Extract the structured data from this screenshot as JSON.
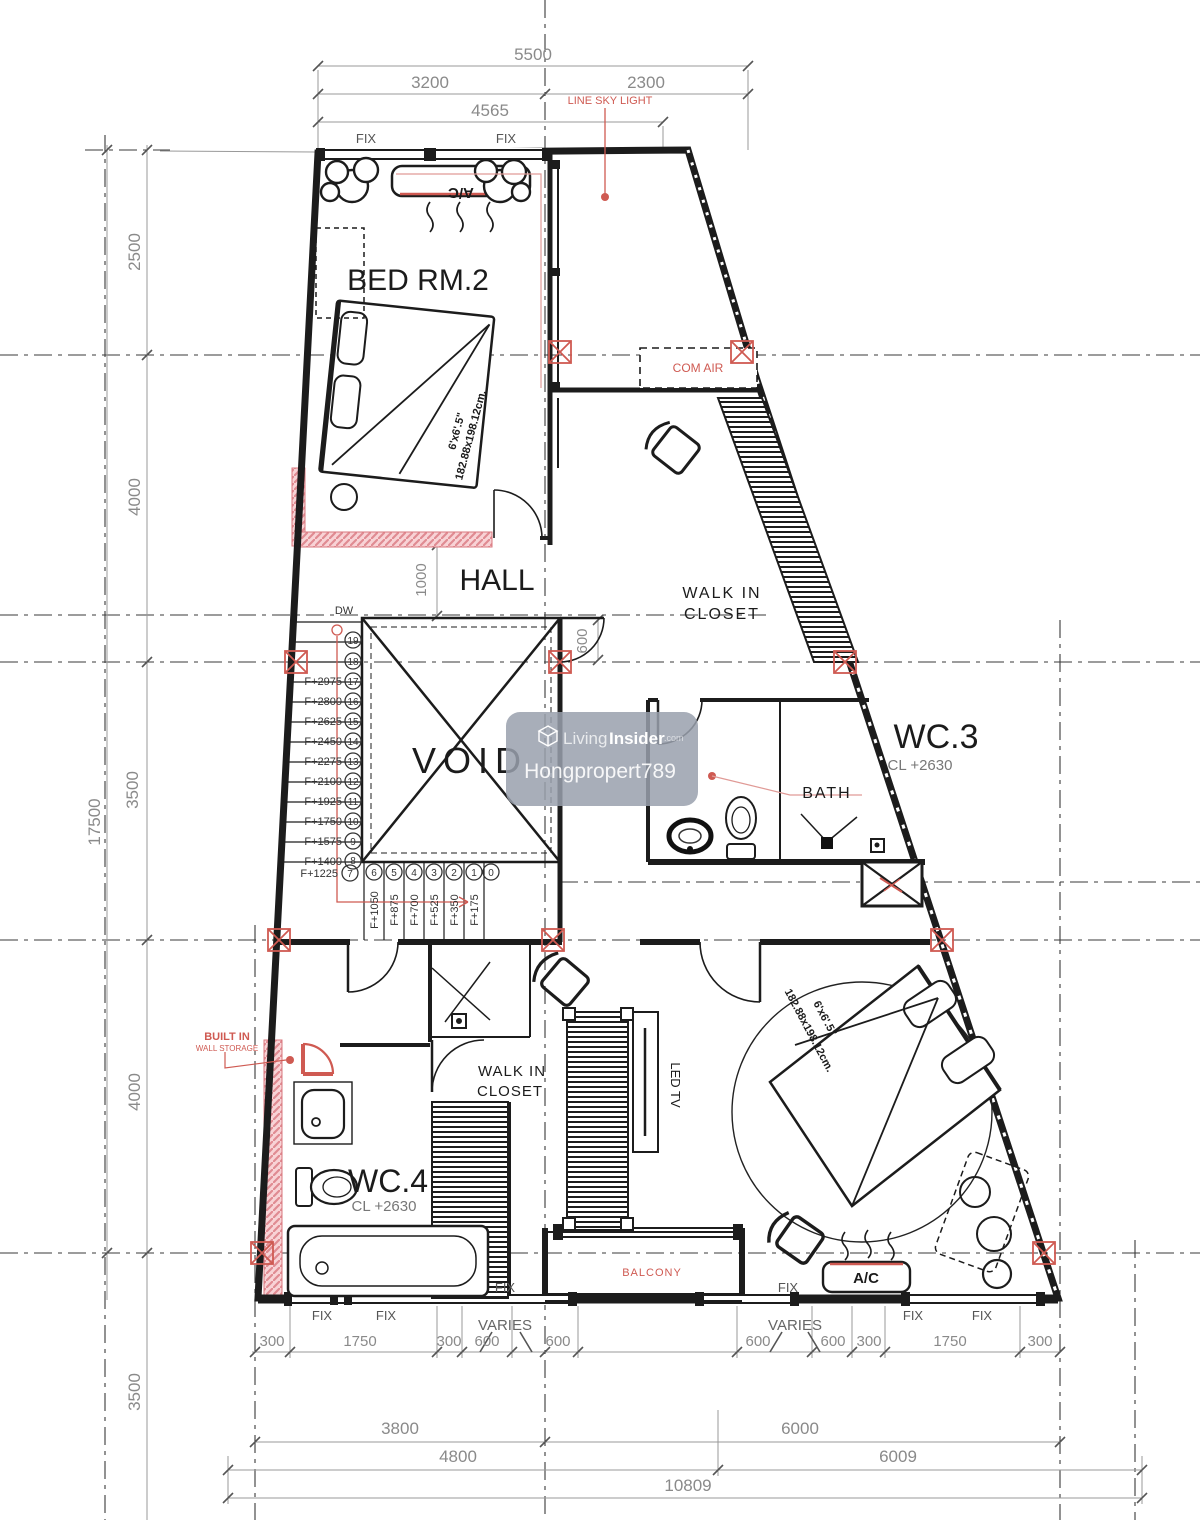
{
  "colors": {
    "line": "#1c1c1c",
    "dim_text": "#8a8a8a",
    "annotation_red": "#cf5a52",
    "wall_pink": "#f2b3b8",
    "watermark_bg": "#99a0ad",
    "watermark_text": "#ffffff"
  },
  "rooms": {
    "bedroom2": "BED RM.2",
    "hall": "HALL",
    "void": "VOID",
    "wc3": "WC.3",
    "wc3_ceiling": "CL  +2630",
    "wc4": "WC.4",
    "wc4_ceiling": "CL  +2630",
    "bath": "BATH",
    "walk_in_line1": "WALK  IN",
    "walk_in_line2": "CLOSET",
    "balcony": "BALCONY"
  },
  "annotations": {
    "line_sky_light": "LINE  SKY  LIGHT",
    "com_air": "COM  AIR",
    "ac": "A/C",
    "fix": "FIX",
    "varies": "VARIES",
    "dw": "DW",
    "built_in_line1": "BUILT  IN",
    "built_in_line2": "WALL STORAGE",
    "led_tv": "LED  TV",
    "bed_size_line1": "6'x6'.5\"",
    "bed_size_line2": "182.88x198.12cm."
  },
  "dimensions": {
    "top": {
      "d5500": "5500",
      "d3200": "3200",
      "d2300": "2300",
      "d4565": "4565"
    },
    "left": {
      "d2500": "2500",
      "d4000_upper": "4000",
      "d3500_mid": "3500",
      "d17500": "17500",
      "d4000_lower": "4000",
      "d3500_bottom": "3500"
    },
    "interior": {
      "hall_1000": "1000",
      "corridor_600": "600"
    },
    "bottom_small_left": [
      "300",
      "1750",
      "300",
      "600",
      "600"
    ],
    "bottom_small_right": [
      "600",
      "600",
      "300",
      "1750",
      "300"
    ],
    "bottom_row1": [
      "3800",
      "6000"
    ],
    "bottom_row2": [
      "4800",
      "6009"
    ],
    "bottom_total": "10809"
  },
  "stairs": {
    "upper_steps": [
      "19",
      "18"
    ],
    "risers": [
      {
        "label": "F+2975",
        "step": "17"
      },
      {
        "label": "F+2800",
        "step": "16"
      },
      {
        "label": "F+2625",
        "step": "15"
      },
      {
        "label": "F+2450",
        "step": "14"
      },
      {
        "label": "F+2275",
        "step": "13"
      },
      {
        "label": "F+2100",
        "step": "12"
      },
      {
        "label": "F+1925",
        "step": "11"
      },
      {
        "label": "F+1750",
        "step": "10"
      },
      {
        "label": "F+1575",
        "step": "9"
      },
      {
        "label": "F+1400",
        "step": "8"
      },
      {
        "label": "F+1225",
        "step": "7"
      }
    ],
    "treads": [
      {
        "label": "F+1050",
        "step": "6"
      },
      {
        "label": "F+875",
        "step": "5"
      },
      {
        "label": "F+700",
        "step": "4"
      },
      {
        "label": "F+525",
        "step": "3"
      },
      {
        "label": "F+350",
        "step": "2"
      },
      {
        "label": "F+175",
        "step": "1"
      },
      {
        "label": "",
        "step": "0"
      }
    ]
  },
  "watermark": {
    "brand_light": "Living",
    "brand_bold": "Insider",
    "brand_tld": ".com",
    "username": "Hongpropert789"
  }
}
